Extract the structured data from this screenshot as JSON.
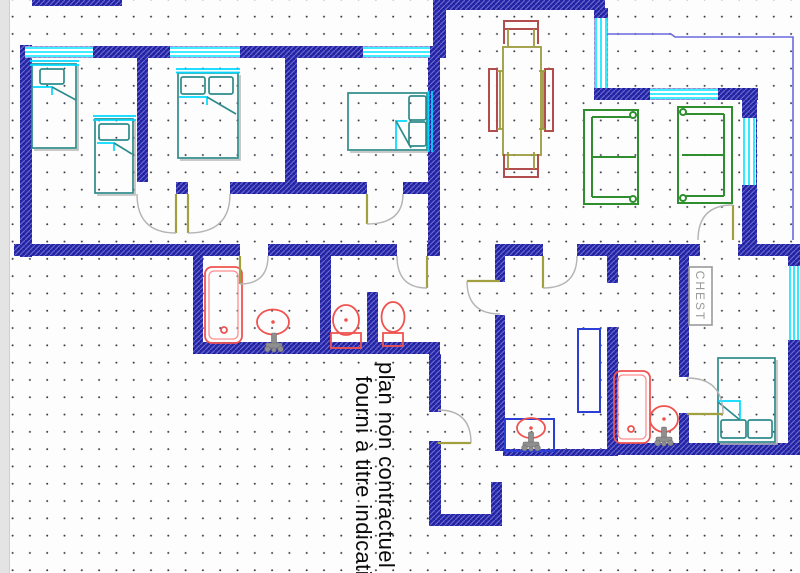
{
  "disclaimer": {
    "line1": "plan non contractuel",
    "line2": "fourni à titre indicatif"
  },
  "labels": {
    "chest": "CHEST"
  },
  "palette": {
    "background": "#fdfdfd",
    "grid_dot": "#3b3b4d",
    "wall_blue": "#2525a8",
    "wall_hatch_light": "#6868cc",
    "window_cyan": "#00e5ff",
    "terrace_line_blue": "#6a6ae0",
    "furniture_teal": "#2e8b8b",
    "blanket_cyan": "#00d9ff",
    "shadow_gray": "#b8b8b8",
    "sofa_green": "#2f8f2f",
    "table_olive": "#9a9a3e",
    "chair_red": "#b24d4d",
    "fixture_red": "#ef5350",
    "fixture_red_light": "#ff8f8f",
    "faucet_gray": "#8f8f8f",
    "cabinet_blue": "#2b3fd6",
    "door_leaf_olive": "#a0a040",
    "door_arc_gray": "#b4b4b4",
    "chest_gray": "#9a9a9a",
    "margin_strip": "#e4e4e4",
    "text_black": "#0a0a0a"
  }
}
